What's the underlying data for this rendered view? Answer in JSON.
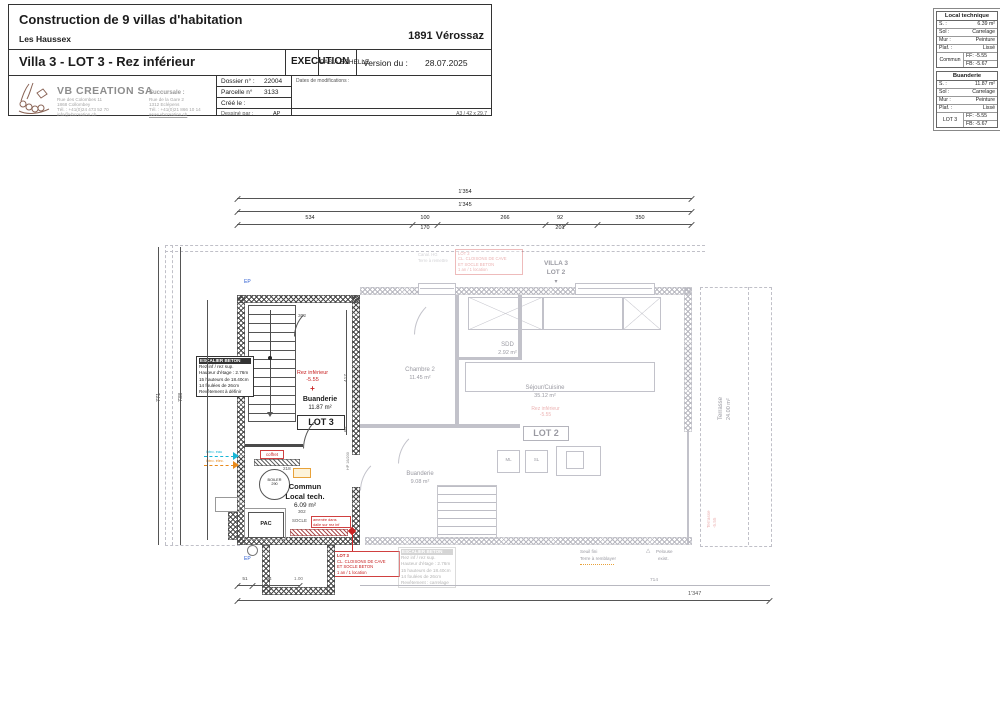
{
  "title_block": {
    "project": "Construction de 9 villas d'habitation",
    "district": "Les Haussex",
    "city": "1891 Vérossaz",
    "sheet_title": "Villa 3 - LOT 3 - Rez inférieur",
    "phase": "EXECUTION",
    "scale_note": "PAS A ECHELLE",
    "version_label": "Version du :",
    "version_date": "28.07.2025",
    "dossier_label": "Dossier n° :",
    "dossier_value": "22004",
    "parcelle_label": "Parcelle n°",
    "parcelle_value": "3133",
    "cree_label": "Créé le :",
    "dessine_label": "Dessiné par :",
    "dessine_value": "AP",
    "mods_label": "Dates de modifications :",
    "format_note": "A3 / 42 x 29.7",
    "company": {
      "name": "VB CREATION SA",
      "addr1": "Rue des Colombes 11",
      "addr2": "1868 Collombey",
      "tel": "Tél. : +41(0)24 473 52 70",
      "email": "info@vbcreation.ch",
      "branch_label": "Succursale :",
      "branch_addr1": "Rue de la Gare 2",
      "branch_addr2": "1312 Eclépens",
      "branch_tel": "Tél. : +41(0)21 866 10 14",
      "website": "www.vbcreation.ch"
    }
  },
  "spec_tables": {
    "row_labels": {
      "s": "S. :",
      "sol": "Sol :",
      "mur": "Mur :",
      "plaf": "Plaf. :"
    },
    "local_technique": {
      "title": "Local technique",
      "s": "6.39 m²",
      "sol": "Carrelage",
      "mur": "Peinture",
      "plaf": "Lissé",
      "owner": "Commun",
      "ff": "FF: -5.55",
      "fb": "FB: -5.67"
    },
    "buanderie": {
      "title": "Buanderie",
      "s": "11.87 m²",
      "sol": "Carrelage",
      "mur": "Peinture",
      "plaf": "Lissé",
      "owner": "LOT 3",
      "ff": "FF: -5.55",
      "fb": "FB: -5.67"
    }
  },
  "plan": {
    "header": {
      "villa": "VILLA 3",
      "lot": "LOT 2"
    },
    "rooms": {
      "buanderie3": {
        "name": "Buanderie",
        "area": "11.87 m²",
        "lot": "LOT 3"
      },
      "commun": {
        "line1": "Commun",
        "line2": "Local tech.",
        "area": "6.09 m²"
      },
      "chambre2": {
        "name": "Chambre 2",
        "area": "11.45 m²"
      },
      "sdd": {
        "name": "SDD",
        "area": "2.92 m²"
      },
      "sejour": {
        "name": "Séjour/Cuisine",
        "area": "35.12 m²",
        "lot": "LOT 2"
      },
      "buanderie2": {
        "name": "Buanderie",
        "area": "9.08 m²"
      },
      "terrasse": {
        "name": "Terrasse",
        "area": "24.00 m²"
      }
    },
    "levels": {
      "rez": "Rez inférieur",
      "value": "-5.55",
      "terrasse": "Terrasse"
    },
    "stair_note": {
      "l1": "ESCALIER BETON",
      "l2": "Rez inf / rez sup.",
      "l3": "Hauteur d'étage : 2.76m",
      "l4": "15 hauteurs de 18.40cm",
      "l5": "14 foulées de 26cm",
      "l6": "Revêtement à définir"
    },
    "stair_note2": {
      "l1": "ESCALIER BETON",
      "l2": "Rez inf / rez sup.",
      "l3": "Hauteur d'étage : 2.76m",
      "l4": "15 hauteurs de 18.40cm",
      "l5": "14 foulées de 26cm",
      "l6": "Revêtement : carrelage"
    },
    "red_note_lot3": {
      "l1": "LOT 3",
      "l2": "CL. CLOISONS DE CAVE",
      "l3": "ET SOCLE BETON",
      "l4": "1 an / 1 location"
    },
    "red_note_lot2": {
      "l1": "LOT 2",
      "l2": "CL. CLOISONS DE CAVE",
      "l3": "ET SOCLE BETON",
      "l4": "1 an / 1 location"
    },
    "socle_note": {
      "l1": "amenée dans",
      "l2": "dalle sur rez inf"
    },
    "equip": {
      "coffret": "coffret",
      "boiler": "BOILER",
      "boiler2": "290",
      "pac": "PAC",
      "socle": "SOCLE",
      "hp": "HP 16/200",
      "ml": "ML",
      "sl": "SL",
      "ep": "EP"
    },
    "intro": {
      "eau": "intro. eau",
      "elec": "intro. élec."
    },
    "site": {
      "canal": "Canal. HG",
      "terre": "Terre à remettre",
      "seuil": "Seuil fini",
      "remblai": "Terre à remblayer",
      "pelouse": "Pelouse",
      "exist": "exist."
    },
    "dims": {
      "top_total": "1'354",
      "top_inner": "1'345",
      "seg1": "534",
      "seg2": "100",
      "seg2b": "170",
      "seg3": "266",
      "seg4": "92",
      "seg4b": "201",
      "seg5": "350",
      "bottom_total": "1'347",
      "left_outer": "771",
      "left_inner": "738",
      "d302a": "302",
      "d417": "417",
      "d60": "60",
      "d218": "218",
      "d302b": "302",
      "d51": "51",
      "d94": "94",
      "d100": "1.00",
      "d714": "714",
      "d20": "20"
    }
  }
}
